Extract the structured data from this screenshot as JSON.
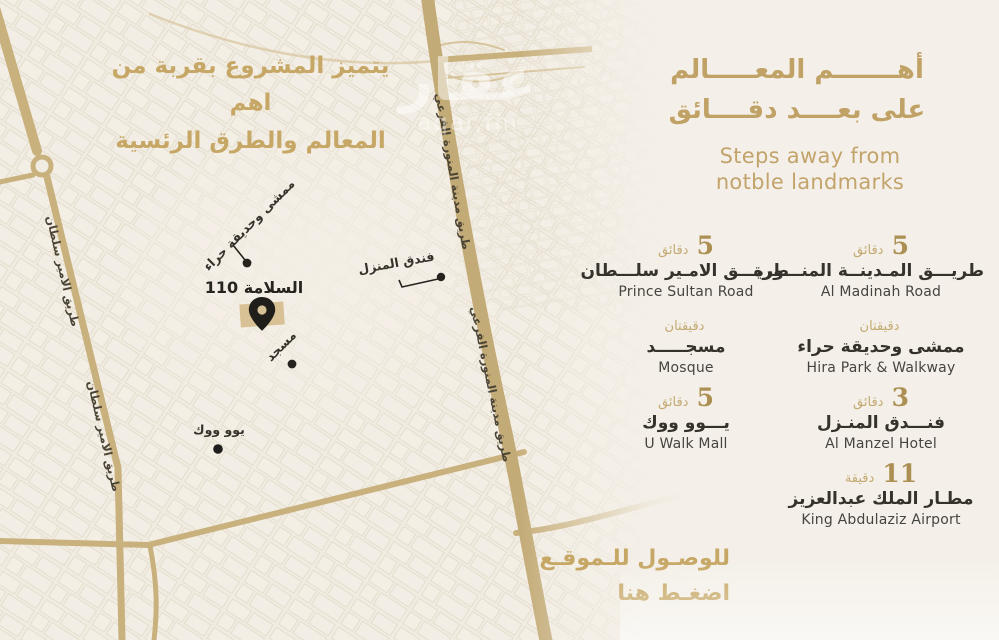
{
  "colors": {
    "gold_text": "#c1a266",
    "road_gold": "#c9b17e",
    "road_main": "#c3ab77",
    "dark_label": "#35322c",
    "english_text": "#45443f",
    "map_bg": "#f1ece2",
    "panel_bg": "#f4f0e9",
    "pin_block": "#d8c194"
  },
  "map": {
    "intro": {
      "line1": "يتميز المشروع بقربة من اهم",
      "line2": "المعالم والطرق الرئسية"
    },
    "road_labels": {
      "prince_sultan": "طريق الامير سلطان",
      "madinah_branch": "طريق مدينة المنورة الفرعي"
    },
    "poi": {
      "hira": "ممشى وحديقة حراء",
      "project": "السلامة 110",
      "mosque": "مسجد",
      "hotel": "فندق المنزل",
      "uwalk": "يوو ووك"
    },
    "watermark": {
      "ar": "عقار",
      "latin": "aqar.fm"
    }
  },
  "panel": {
    "title": {
      "ar_line1": "أهـــــــم المعـــــالم",
      "ar_line2": "على بعــــد دقــــائق",
      "en_line1": "Steps away from",
      "en_line2": "notble landmarks"
    },
    "columns": {
      "left": [
        {
          "time_value": "5",
          "time_unit": "دقائق",
          "name_ar": "طريـــق الامـير سلـــطان",
          "name_en": "Prince Sultan Road"
        },
        {
          "time_value": "",
          "time_unit": "دقيقتان",
          "name_ar": "مسجـــــد",
          "name_en": "Mosque"
        },
        {
          "time_value": "5",
          "time_unit": "دقائق",
          "name_ar": "يـــوو ووك",
          "name_en": "U Walk Mall"
        }
      ],
      "right": [
        {
          "time_value": "5",
          "time_unit": "دقائق",
          "name_ar": "طريـــق المـدينــة المنـــورة",
          "name_en": "Al Madinah Road"
        },
        {
          "time_value": "",
          "time_unit": "دقيقتان",
          "name_ar": "ممشى وحديقة حراء",
          "name_en": "Hira Park & Walkway"
        },
        {
          "time_value": "3",
          "time_unit": "دقائق",
          "name_ar": "فنـــدق المنـزل",
          "name_en": "Al Manzel Hotel"
        },
        {
          "time_value": "11",
          "time_unit": "دقيقة",
          "name_ar": "مطـار الملك عبدالعزيز",
          "name_en": "King Abdulaziz Airport"
        }
      ]
    },
    "cta": {
      "line1": "للوصـول للـموقـع",
      "line2": "اضغـط هنا"
    }
  }
}
